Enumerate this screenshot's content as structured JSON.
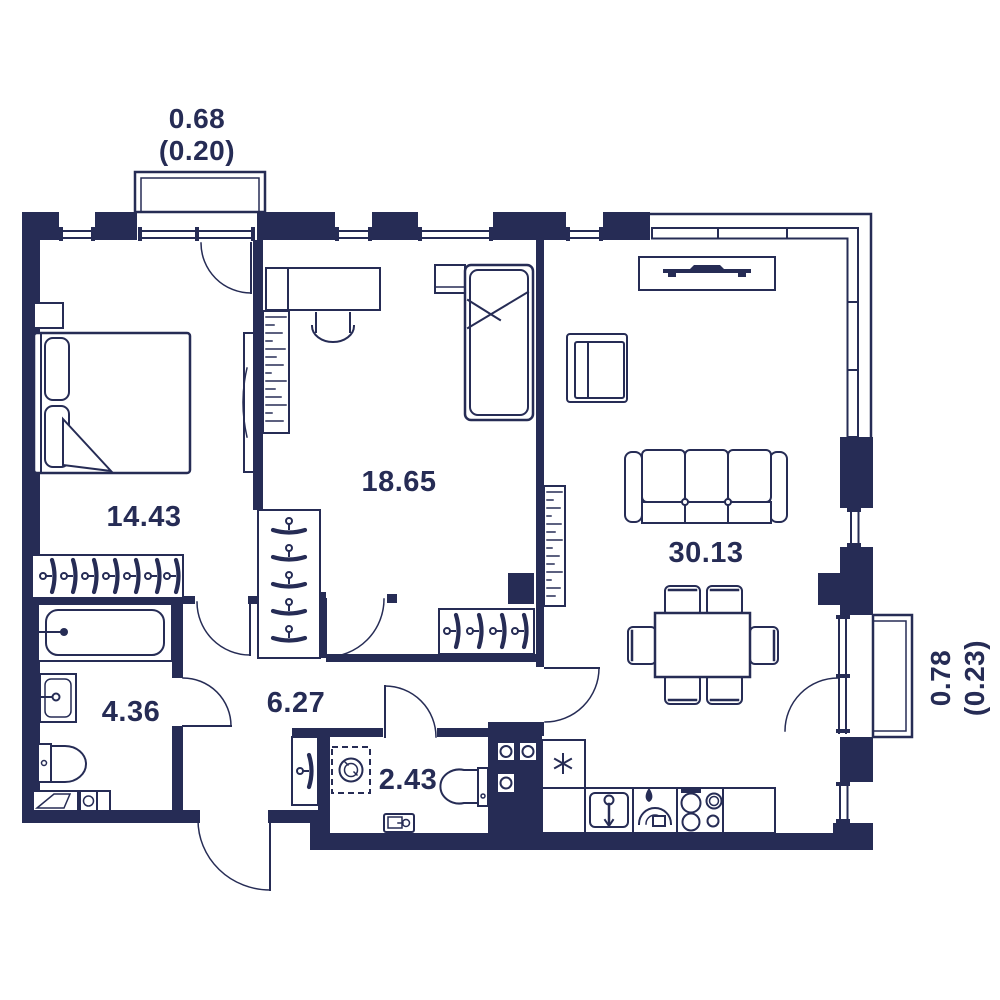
{
  "plan": {
    "background": "#ffffff",
    "ink_color": "#262c55",
    "rooms": [
      {
        "id": "bedroom",
        "area": "14.43"
      },
      {
        "id": "bedroom-2",
        "area": "18.65"
      },
      {
        "id": "living-room-kitchen",
        "area": "30.13"
      },
      {
        "id": "bathroom",
        "area": "4.36"
      },
      {
        "id": "hallway",
        "area": "6.27"
      },
      {
        "id": "wc",
        "area": "2.43"
      }
    ],
    "balconies": [
      {
        "id": "balcony-top",
        "area": "0.68",
        "reduced": "(0.20)"
      },
      {
        "id": "balcony-right",
        "area": "0.78",
        "reduced": "(0.23)"
      }
    ]
  }
}
